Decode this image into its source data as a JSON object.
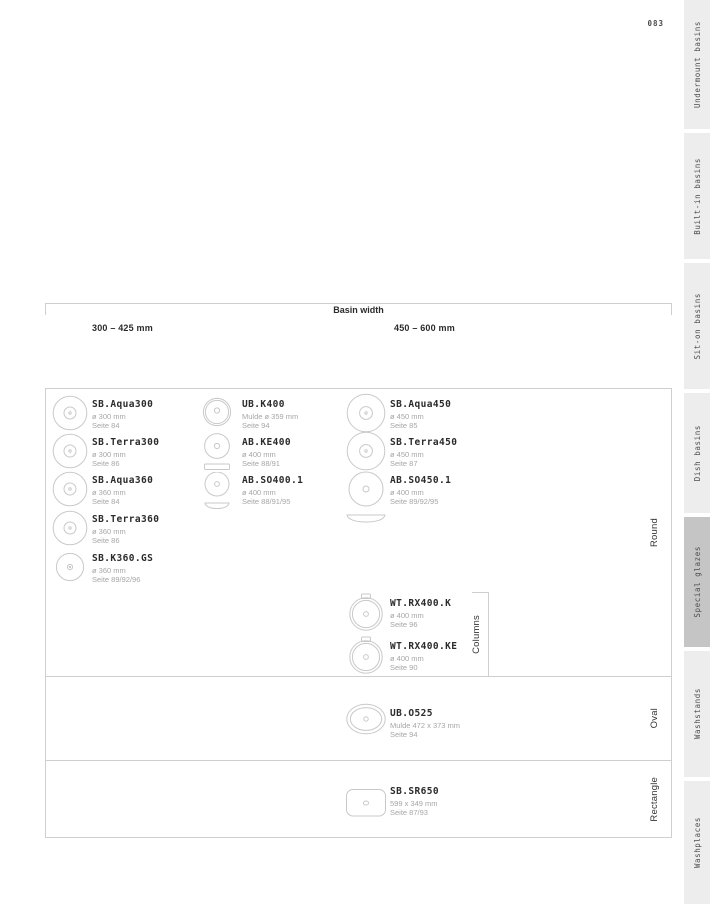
{
  "page_number": "083",
  "sidebar": {
    "items": [
      {
        "label": "Undermount basins",
        "selected": false
      },
      {
        "label": "Built-in basins",
        "selected": false
      },
      {
        "label": "Sit-on basins",
        "selected": false
      },
      {
        "label": "Dish basins",
        "selected": false
      },
      {
        "label": "Special glazes",
        "selected": true
      },
      {
        "label": "Washstands",
        "selected": false
      },
      {
        "label": "Washplaces",
        "selected": false
      }
    ]
  },
  "table": {
    "axis_title": "Basin width",
    "col_headers": [
      "300 – 425 mm",
      "450 – 600 mm"
    ],
    "row_labels": {
      "round": "Round",
      "oval": "Oval",
      "rectangle": "Rectangle"
    },
    "columns_label": "Columns",
    "products": {
      "round_col1": [
        {
          "name": "SB.Aqua300",
          "detail": "ø 300 mm",
          "page": "Seite 84"
        },
        {
          "name": "SB.Terra300",
          "detail": "ø 300 mm",
          "page": "Seite 86"
        },
        {
          "name": "SB.Aqua360",
          "detail": "ø 360 mm",
          "page": "Seite 84"
        },
        {
          "name": "SB.Terra360",
          "detail": "ø 360 mm",
          "page": "Seite 86"
        },
        {
          "name": "SB.K360.GS",
          "detail": "ø 360 mm",
          "page": "Seite 89/92/96"
        }
      ],
      "round_col2": [
        {
          "name": "UB.K400",
          "detail": "Mulde ø 359 mm",
          "page": "Seite 94"
        },
        {
          "name": "AB.KE400",
          "detail": "ø 400 mm",
          "page": "Seite 88/91"
        },
        {
          "name": "AB.SO400.1",
          "detail": "ø 400 mm",
          "page": "Seite 88/91/95"
        }
      ],
      "round_col3": [
        {
          "name": "SB.Aqua450",
          "detail": "ø 450 mm",
          "page": "Seite 85"
        },
        {
          "name": "SB.Terra450",
          "detail": "ø 450 mm",
          "page": "Seite 87"
        },
        {
          "name": "AB.SO450.1",
          "detail": "ø 400 mm",
          "page": "Seite 89/92/95"
        }
      ],
      "round_columns": [
        {
          "name": "WT.RX400.K",
          "detail": "ø 400 mm",
          "page": "Seite 96"
        },
        {
          "name": "WT.RX400.KE",
          "detail": "ø 400 mm",
          "page": "Seite 90"
        }
      ],
      "oval": [
        {
          "name": "UB.O525",
          "detail": "Mulde 472 x 373 mm",
          "page": "Seite 94"
        }
      ],
      "rectangle": [
        {
          "name": "SB.SR650",
          "detail": "599 x 349 mm",
          "page": "Seite 87/93"
        }
      ]
    }
  },
  "colors": {
    "sidebar_bg": "#ededed",
    "sidebar_selected": "#c5c5c5",
    "border": "#cfcfcf",
    "icon_stroke": "#c9c9c9"
  }
}
